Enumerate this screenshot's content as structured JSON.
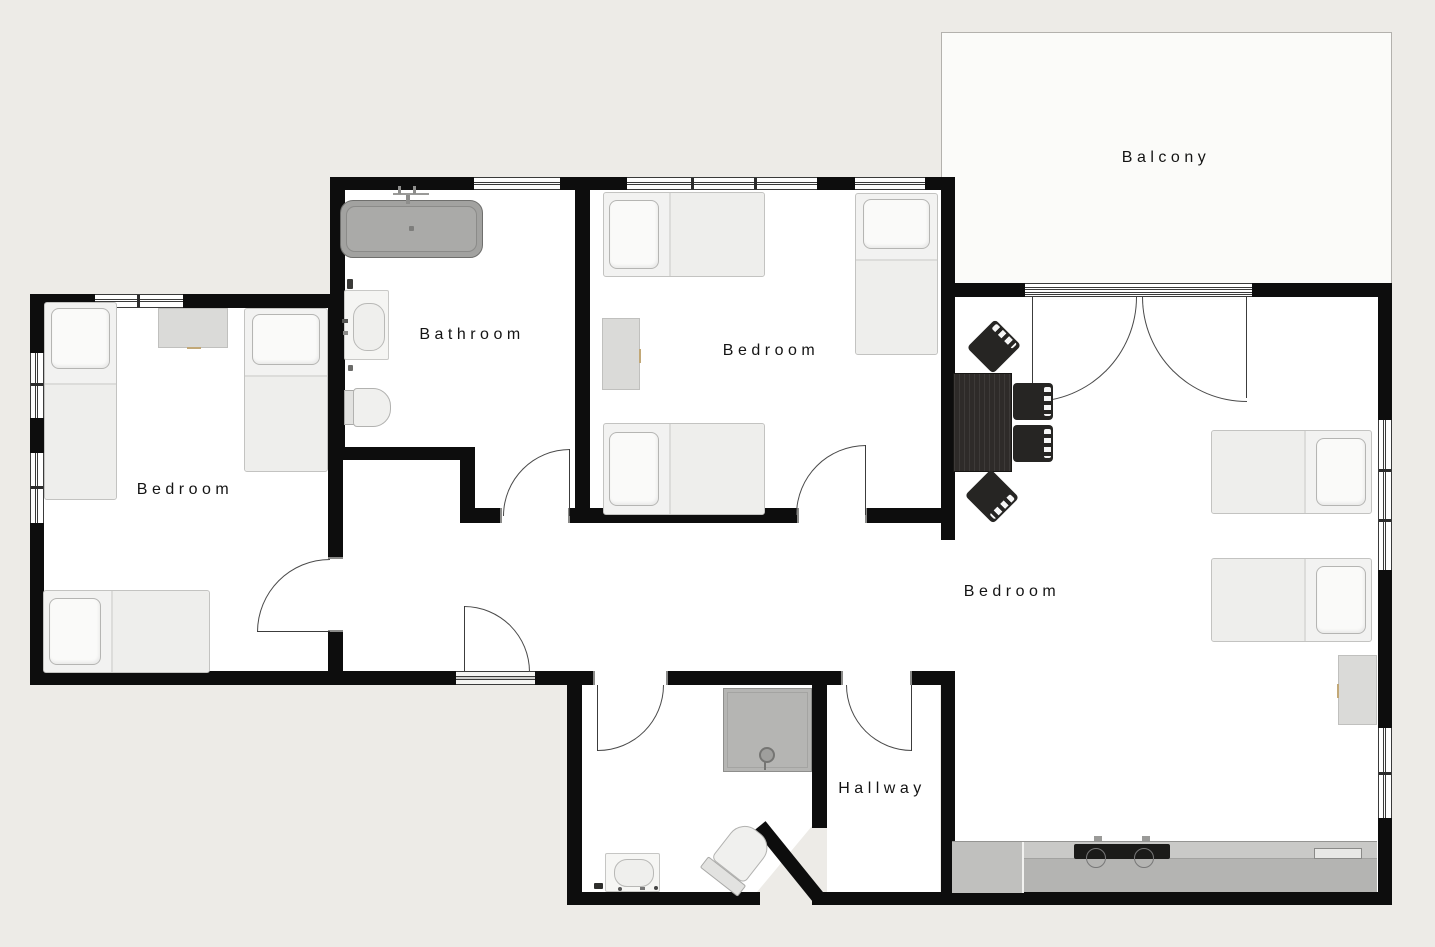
{
  "plan": {
    "title": "Apartment floor plan",
    "rooms": [
      {
        "id": "balcony",
        "label": "Balcony"
      },
      {
        "id": "bathroom",
        "label": "Bathroom"
      },
      {
        "id": "bedroom-center",
        "label": "Bedroom"
      },
      {
        "id": "bedroom-left",
        "label": "Bedroom"
      },
      {
        "id": "bedroom-right",
        "label": "Bedroom"
      },
      {
        "id": "hallway",
        "label": "Hallway"
      }
    ],
    "palette": {
      "wall": "#0d0d0d",
      "floor": "#ffffff",
      "outside": "#edebe7",
      "balcony_floor": "#fbfbf9",
      "dark_furniture": "#262523",
      "counter": "#b7b7b5",
      "bathtub": "#a2a2a0",
      "label_text": "#141414"
    },
    "fixtures": [
      "bed",
      "pillow",
      "desk",
      "nightstand",
      "bathtub",
      "bathroom-sink",
      "toilet",
      "shower",
      "dining-table",
      "chair",
      "kitchen-counter",
      "cooktop",
      "kitchen-sink"
    ]
  }
}
